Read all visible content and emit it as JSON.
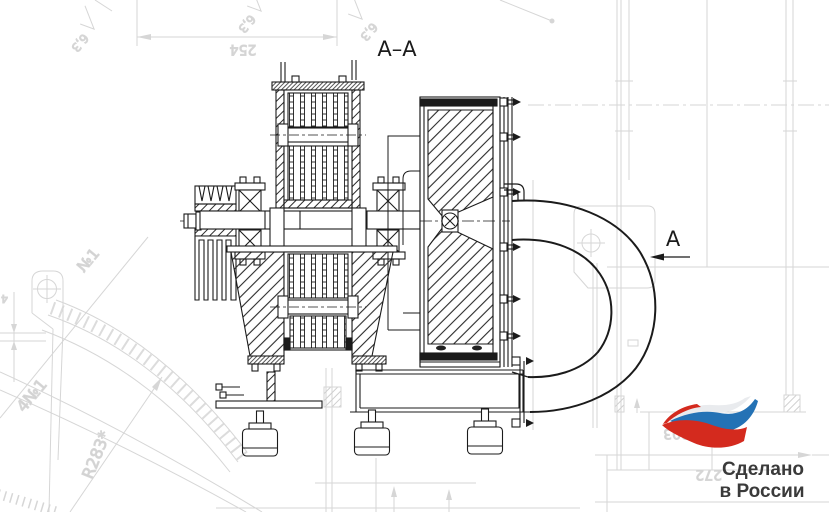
{
  "drawing": {
    "section_label": "А–А",
    "view_arrow_label": "А",
    "roughness": [
      "6,3",
      "6,3",
      "6,3"
    ],
    "dimensions": {
      "dim_254": "254",
      "thickness_4": "4",
      "pos_no1": "№1",
      "pos_4no1": "4№1",
      "radius_r283": "R283*",
      "dim_303": "303",
      "dim_272": "272"
    }
  },
  "logo": {
    "line1": "Сделано",
    "line2": "в России",
    "colors": {
      "red": "#d42a1e",
      "blue": "#2472b5",
      "white": "#e9ebee",
      "text": "#3a3a3a"
    }
  },
  "colors": {
    "ink": "#1b1b1b",
    "faded": "#d6d6d6"
  }
}
